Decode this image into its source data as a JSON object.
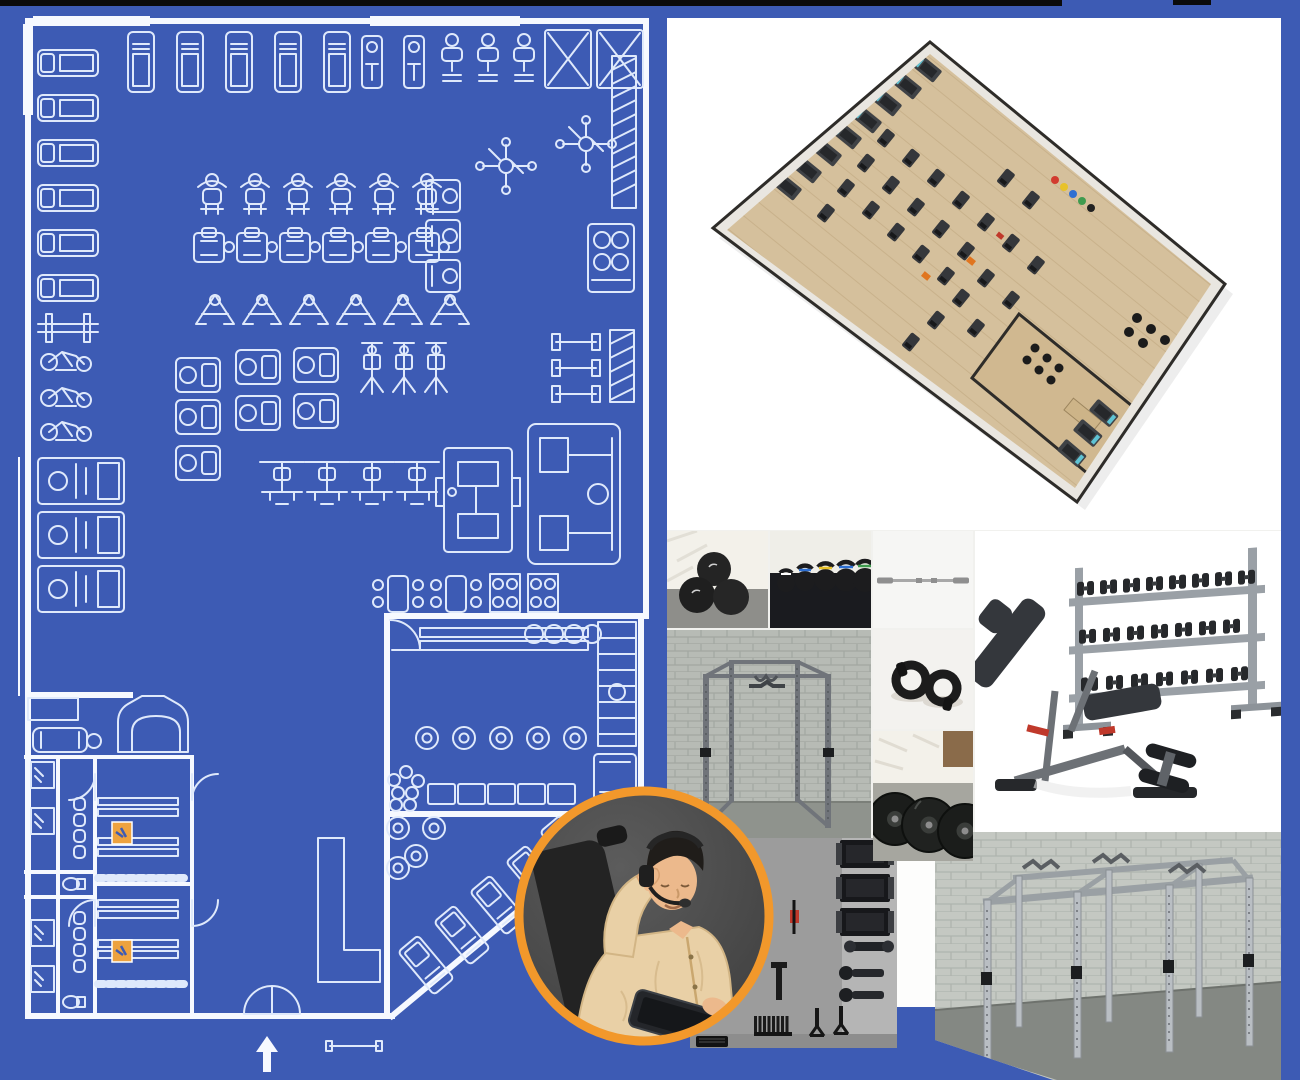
{
  "page": {
    "label": "Gym design and equipment package collage",
    "width": 1300,
    "height": 1080
  },
  "colors": {
    "bg_blue": "#3d5bb4",
    "bp_line": "#dfe9fb",
    "bp_wall": "#f6f9ff",
    "black_bar": "#0b0b0b",
    "orange_ring": "#f2982b",
    "orange_stamp": "#eda23f",
    "wood": "#d5c09c",
    "wood_line": "#c3ac85",
    "wall_fill": "#e9e6e0",
    "wall_edge": "#2e2c29",
    "equip_dark": "#35373b",
    "green_accent": "#7ca36b",
    "orange_accent": "#e0751f",
    "brick": "#b7bbb5",
    "brick_line": "#a2a7a1",
    "brick2": "#c4c8c2",
    "brick2_line": "#afb4ae",
    "steel": "#70747a",
    "steel_light": "#b9bec3",
    "floor_gray": "#8f938d",
    "panel_gray": "#9c9c9c",
    "item_black": "#1c1e20",
    "pad_dark": "#34373c",
    "frame_gray": "#6d7176",
    "red_accent": "#c0392b",
    "skin": "#ecb98c",
    "hair": "#201d1a",
    "shirt_tan": "#e9d0a6",
    "circle_bg": "#4a4a4a",
    "mat_black": "#1a1b1f",
    "bag_white": "#f3f1ea",
    "bar_gray": "#a8a8a8",
    "kb_blue": "#2d6fd2",
    "kb_yellow": "#e8c22a",
    "kb_green": "#3f9b4f"
  },
  "sections": {
    "blueprint": {
      "label": "2D CAD gym floor plan blueprint",
      "entrance_arrow": "up"
    },
    "floorplan_3d": {
      "label": "3D rendered gym floor plan"
    },
    "support": {
      "label": "Customer support agent wearing headset holding tablet"
    },
    "accessories_panel": {
      "label": "Accessory storage wall render"
    },
    "rig_render": {
      "label": "Free-standing pull-up rig render against block wall"
    }
  },
  "product_tiles": [
    {
      "id": "slam-balls",
      "label": "Slam balls"
    },
    {
      "id": "kettlebells",
      "label": "Kettlebell row"
    },
    {
      "id": "barbell",
      "label": "Olympic barbell"
    },
    {
      "id": "dumbbell-rack-bench",
      "label": "Three-tier dumbbell rack with adjustable bench"
    },
    {
      "id": "power-rack",
      "label": "Power rack against block wall"
    },
    {
      "id": "collars",
      "label": "Barbell lock collars"
    },
    {
      "id": "bumper-plates",
      "label": "Bumper plates"
    }
  ]
}
